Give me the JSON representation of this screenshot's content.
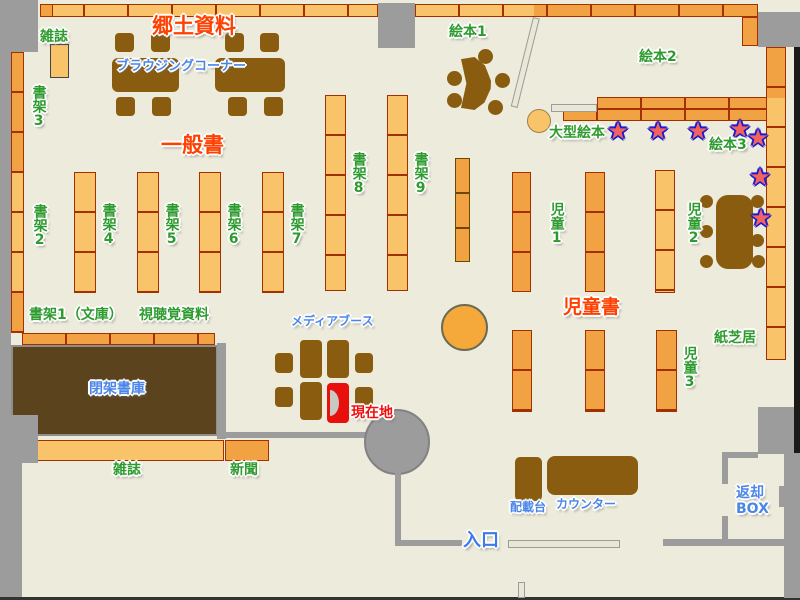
{
  "map_title": "library-floor-map",
  "labels": {
    "magazines_top": "雑誌",
    "local_materials": "郷土資料",
    "browsing_corner": "ブラウジングコーナー",
    "shelf_3": "書架3",
    "general_books": "一般書",
    "shelf_2": "書架2",
    "shelf_4": "書架4",
    "shelf_5": "書架5",
    "shelf_6": "書架6",
    "shelf_7": "書架7",
    "shelf_8": "書架8",
    "shelf_9": "書架9",
    "picture_books_1": "絵本1",
    "picture_books_2": "絵本2",
    "large_picture_books": "大型絵本",
    "picture_books_3": "絵本3",
    "children_1": "児童1",
    "children_2": "児童2",
    "children_books": "児童書",
    "children_3": "児童3",
    "kamishibai": "紙芝居",
    "shelf_1_bunko": "書架1（文庫）",
    "audio_visual": "視聴覚資料",
    "media_booth": "メディアブース",
    "closed_stacks": "閉架書庫",
    "current_location": "現在地",
    "magazines_bottom": "雑誌",
    "newspapers": "新聞",
    "distribution_table": "配載台",
    "counter": "カウンター",
    "return_box_line1": "返却",
    "return_box_line2": "BOX",
    "entrance": "入口"
  },
  "icons": {
    "star": "★"
  },
  "star_count": 7,
  "colors": {
    "background": "#EDEBDB",
    "wall_gray": "#9C9C9C",
    "wall_black": "#1A1A1A",
    "shelf_light": "#F9C469",
    "shelf_dark": "#F1A344",
    "shelf_border": "#A33000",
    "furniture_brown": "#8A5C0F",
    "closed_stack_brown": "#5B431E",
    "label_green": "#2E9B2E",
    "label_red": "#FF4000",
    "label_blue": "#4A86E8",
    "current_location_red": "#F10E0E",
    "star_fill": "#F2635F",
    "star_outline": "#1B1BD0",
    "booth_highlight_red": "#E8100C"
  }
}
